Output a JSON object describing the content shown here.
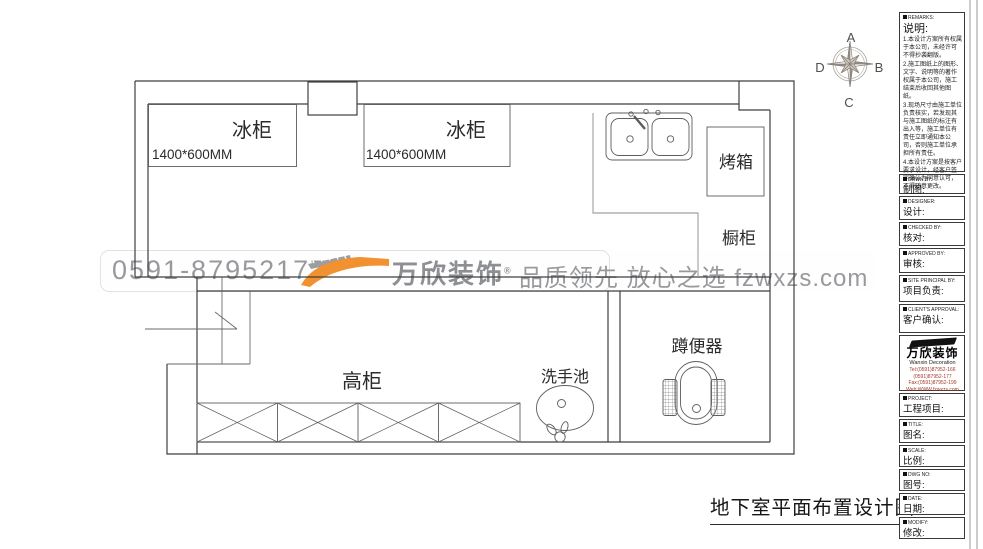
{
  "plan": {
    "labels": {
      "fridge1": "冰柜",
      "fridge1_size": "1400*600MM",
      "fridge2": "冰柜",
      "fridge2_size": "1400*600MM",
      "oven": "烤箱",
      "cupboard": "橱柜",
      "tall_cabinet": "高柜",
      "wash_basin": "洗手池",
      "squat_toilet": "蹲便器"
    },
    "drawing_title": "地下室平面布置设计图"
  },
  "compass": {
    "n": "A",
    "e": "B",
    "s": "C",
    "w": "D"
  },
  "watermark": {
    "phone": "0591-87952177",
    "brand": "万欣装饰",
    "brand_mark": "®",
    "slogan": "品质领先 放心之选 fzwxzs.com",
    "orange": "#f19130",
    "gray": "#97999c"
  },
  "panel": {
    "remarks": {
      "en": "REMARKS:",
      "zh": "说明:",
      "items": [
        "1.本设计方案所有权属于本公司，未经许可不得抄袭翻版。",
        "2.施工图纸上的图形、文字、说明等的著作权属于本公司，施工结束后收回其他图纸。",
        "3.现场尺寸由施工单位负责核实，若发现其与施工图纸的标注有出入等，施工单位有责任立即通知本公司，否则施工单位承担所有责任。",
        "4.本设计方案是按客户要求设计，经客户签字确认为同意认可，不得随意更改。"
      ]
    },
    "fields": [
      {
        "en": "DRWN BY:",
        "zh": "制图:"
      },
      {
        "en": "DESIGNER:",
        "zh": "设计:"
      },
      {
        "en": "CHECKED BY:",
        "zh": "核对:"
      },
      {
        "en": "APPROVED BY:",
        "zh": "审核:"
      },
      {
        "en": "SITE PRINCIPAL BY:",
        "zh": "项目负责:"
      },
      {
        "en": "CLIENT'S APPROVAL:",
        "zh": "客户确认:"
      }
    ],
    "logo": {
      "brand": "万欣装饰",
      "en": "Wanxin Decoration",
      "tel1": "Tel:(0591)87952-166",
      "tel2": "(0591)87952-177",
      "fax": "Fax:(0591)87952-199",
      "web": "Web:WWW.fzwxzs.com"
    },
    "fields2": [
      {
        "en": "PROJECT:",
        "zh": "工程项目:"
      },
      {
        "en": "TITLE:",
        "zh": "图名:"
      },
      {
        "en": "SCALE:",
        "zh": "比例:"
      },
      {
        "en": "DWG NO:",
        "zh": "图号:"
      },
      {
        "en": "DATE:",
        "zh": "日期:"
      },
      {
        "en": "MODIFY:",
        "zh": "修改:"
      }
    ]
  }
}
